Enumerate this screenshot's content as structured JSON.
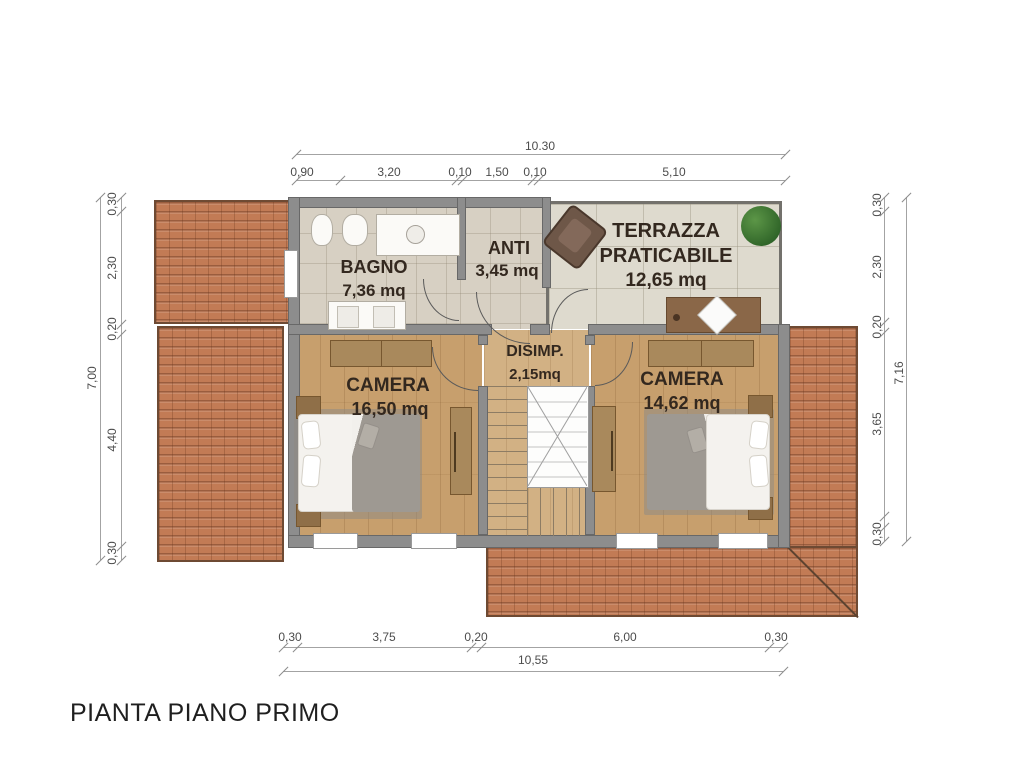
{
  "title": "PIANTA PIANO PRIMO",
  "rooms": {
    "bagno": {
      "name": "BAGNO",
      "area": "7,36 mq"
    },
    "anti": {
      "name": "ANTI",
      "area": "3,45 mq"
    },
    "terrazza": {
      "name_line1": "TERRAZZA",
      "name_line2": "PRATICABILE",
      "area": "12,65 mq"
    },
    "camera1": {
      "name": "CAMERA",
      "area": "16,50 mq"
    },
    "disimp": {
      "name": "DISIMP.",
      "area": "2,15mq"
    },
    "camera2": {
      "name": "CAMERA",
      "area": "14,62 mq"
    }
  },
  "dimensions": {
    "top": {
      "total": "10.30",
      "segments": [
        "0,90",
        "3,20",
        "0,10",
        "1,50",
        "0,10",
        "5,10"
      ]
    },
    "bottom": {
      "total": "10,55",
      "segments": [
        "0,30",
        "3,75",
        "0,20",
        "6,00",
        "0,30"
      ]
    },
    "left": {
      "total": "7,00",
      "segments": [
        "0,30",
        "2,30",
        "0,20",
        "4,40",
        "0,30"
      ]
    },
    "right": {
      "total": "7,16",
      "segments": [
        "0,30",
        "2,30",
        "0,20",
        "3,65",
        "0,30"
      ]
    }
  },
  "colors": {
    "roof_tile": "#c27b55",
    "wall": "#8d8d8d",
    "wood_floor": "#c79f6d",
    "interior_tile": "#d7d0c3",
    "terrace_tile": "#dedace",
    "plant_green": "#3d7a32"
  }
}
